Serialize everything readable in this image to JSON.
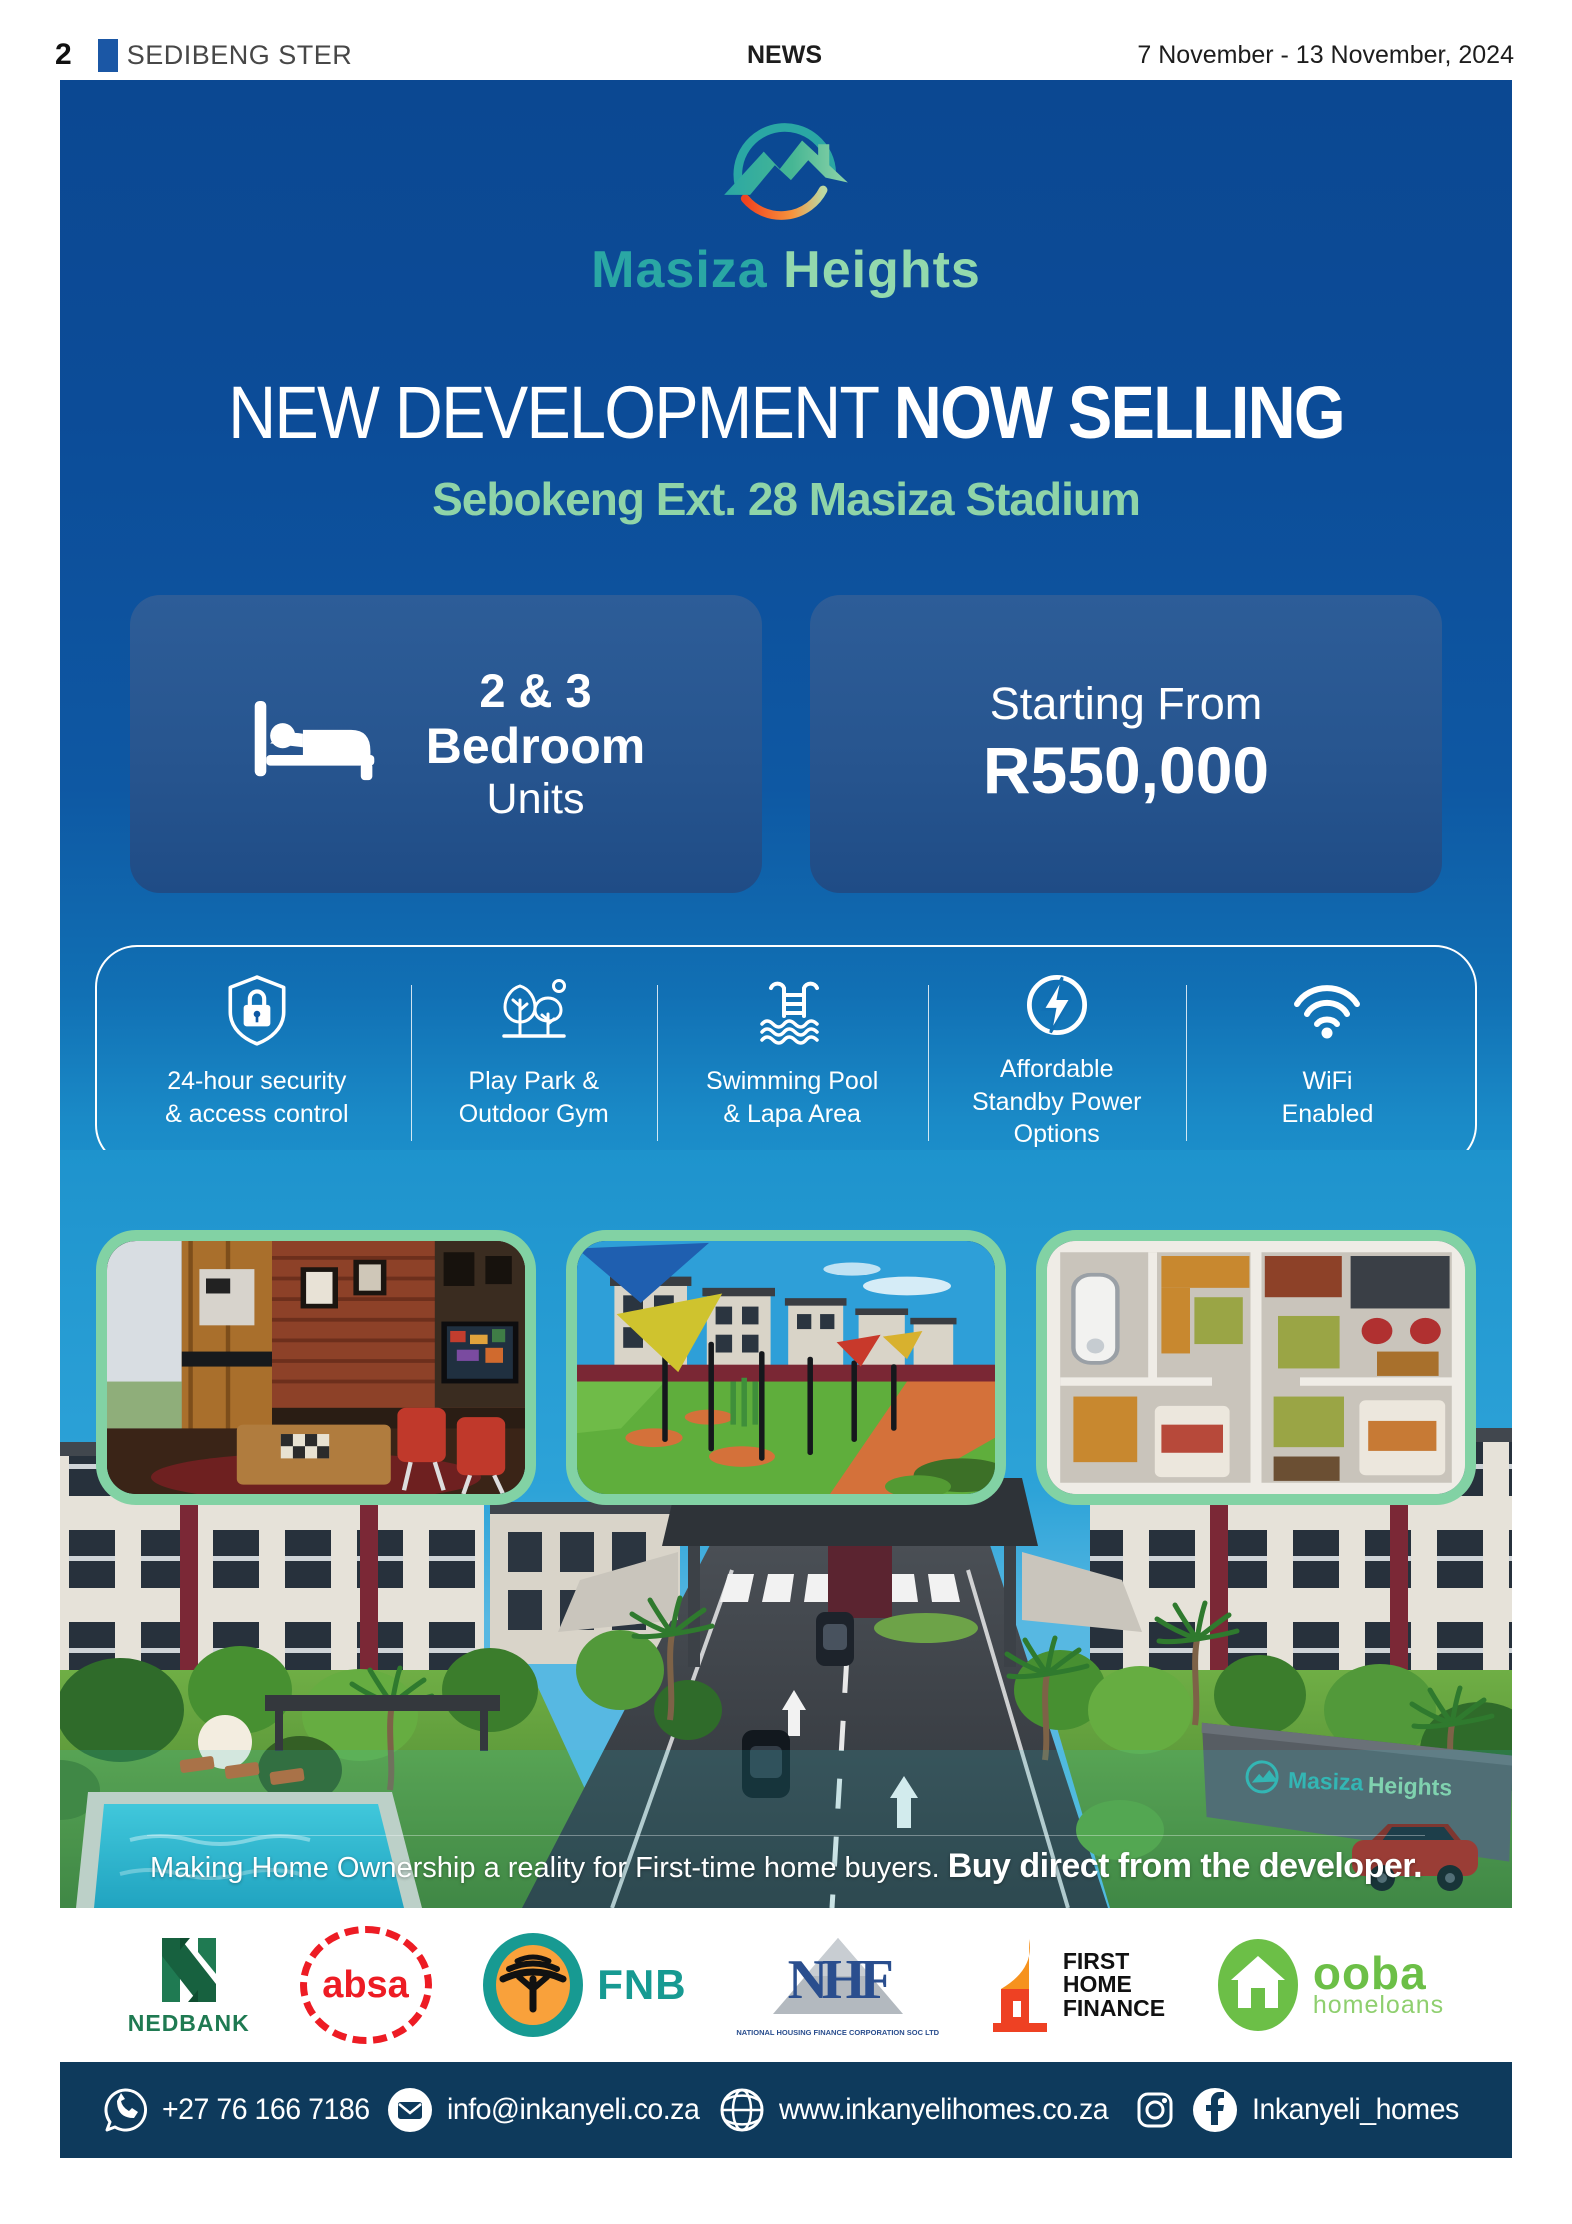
{
  "page": {
    "number": "2",
    "masthead": "SEDIBENG STER",
    "section": "NEWS",
    "date_range": "7 November - 13 November, 2024"
  },
  "brand": {
    "primary": "Masiza",
    "secondary": "Heights",
    "logo_icon": "mountain-circle-logo"
  },
  "headline": {
    "regular": "NEW DEVELOPMENT ",
    "bold": "NOW SELLING"
  },
  "location": "Sebokeng Ext. 28 Masiza Stadium",
  "card_units": {
    "icon": "bed-icon",
    "line1": "2 & 3",
    "line2": "Bedroom",
    "line3": "Units"
  },
  "card_price": {
    "label": "Starting From",
    "price": "R550,000"
  },
  "features": [
    {
      "icon": "security-shield-lock-icon",
      "line1": "24-hour security",
      "line2": "& access control"
    },
    {
      "icon": "play-park-trees-icon",
      "line1": "Play Park &",
      "line2": "Outdoor Gym"
    },
    {
      "icon": "pool-ladder-icon",
      "line1": "Swimming Pool",
      "line2": "& Lapa Area"
    },
    {
      "icon": "standby-power-icon",
      "line1": "Affordable",
      "line2": "Standby Power",
      "line3": "Options"
    },
    {
      "icon": "wifi-icon",
      "line1": "WiFi",
      "line2": "Enabled"
    }
  ],
  "gallery": [
    {
      "name": "interior-kitchen-living-photo"
    },
    {
      "name": "play-park-render-photo"
    },
    {
      "name": "apartment-floorplan-top-view-photo"
    }
  ],
  "scene_sign": {
    "primary": "Masiza",
    "secondary": "Heights"
  },
  "tagline": {
    "regular": "Making Home Ownership a reality for First-time home buyers. ",
    "bold": "Buy direct from the developer."
  },
  "partners": {
    "nedbank": {
      "label": "NEDBANK"
    },
    "absa": {
      "label": "absa"
    },
    "fnb": {
      "label": "FNB"
    },
    "nhf": {
      "letters": "NHF",
      "caption": "NATIONAL HOUSING FINANCE CORPORATION SOC LTD"
    },
    "first_home_finance": {
      "line1": "FIRST",
      "line2": "HOME",
      "line3": "FINANCE"
    },
    "ooba": {
      "label": "ooba",
      "sub": "homeloans"
    }
  },
  "contact": {
    "phone": "+27 76 166 7186",
    "email": "info@inkanyeli.co.za",
    "website": "www.inkanyelihomes.co.za",
    "social": "Inkanyeli_homes"
  },
  "colors": {
    "ad_blue_top": "#0b4892",
    "sky_blue": "#1e93cd",
    "teal": "#2aa7a4",
    "light_green": "#8fd4a8",
    "thumb_border": "#82d2a4",
    "navy_bar": "#0e3a5c",
    "absa_red": "#ed1c24",
    "nedbank_green": "#1f7a52",
    "fnb_teal": "#179a92",
    "fnb_orange": "#f9a13b",
    "fhf_orange": "#f6921e",
    "ooba_green": "#6cbf47",
    "nhf_blue": "#2a4e8e"
  }
}
